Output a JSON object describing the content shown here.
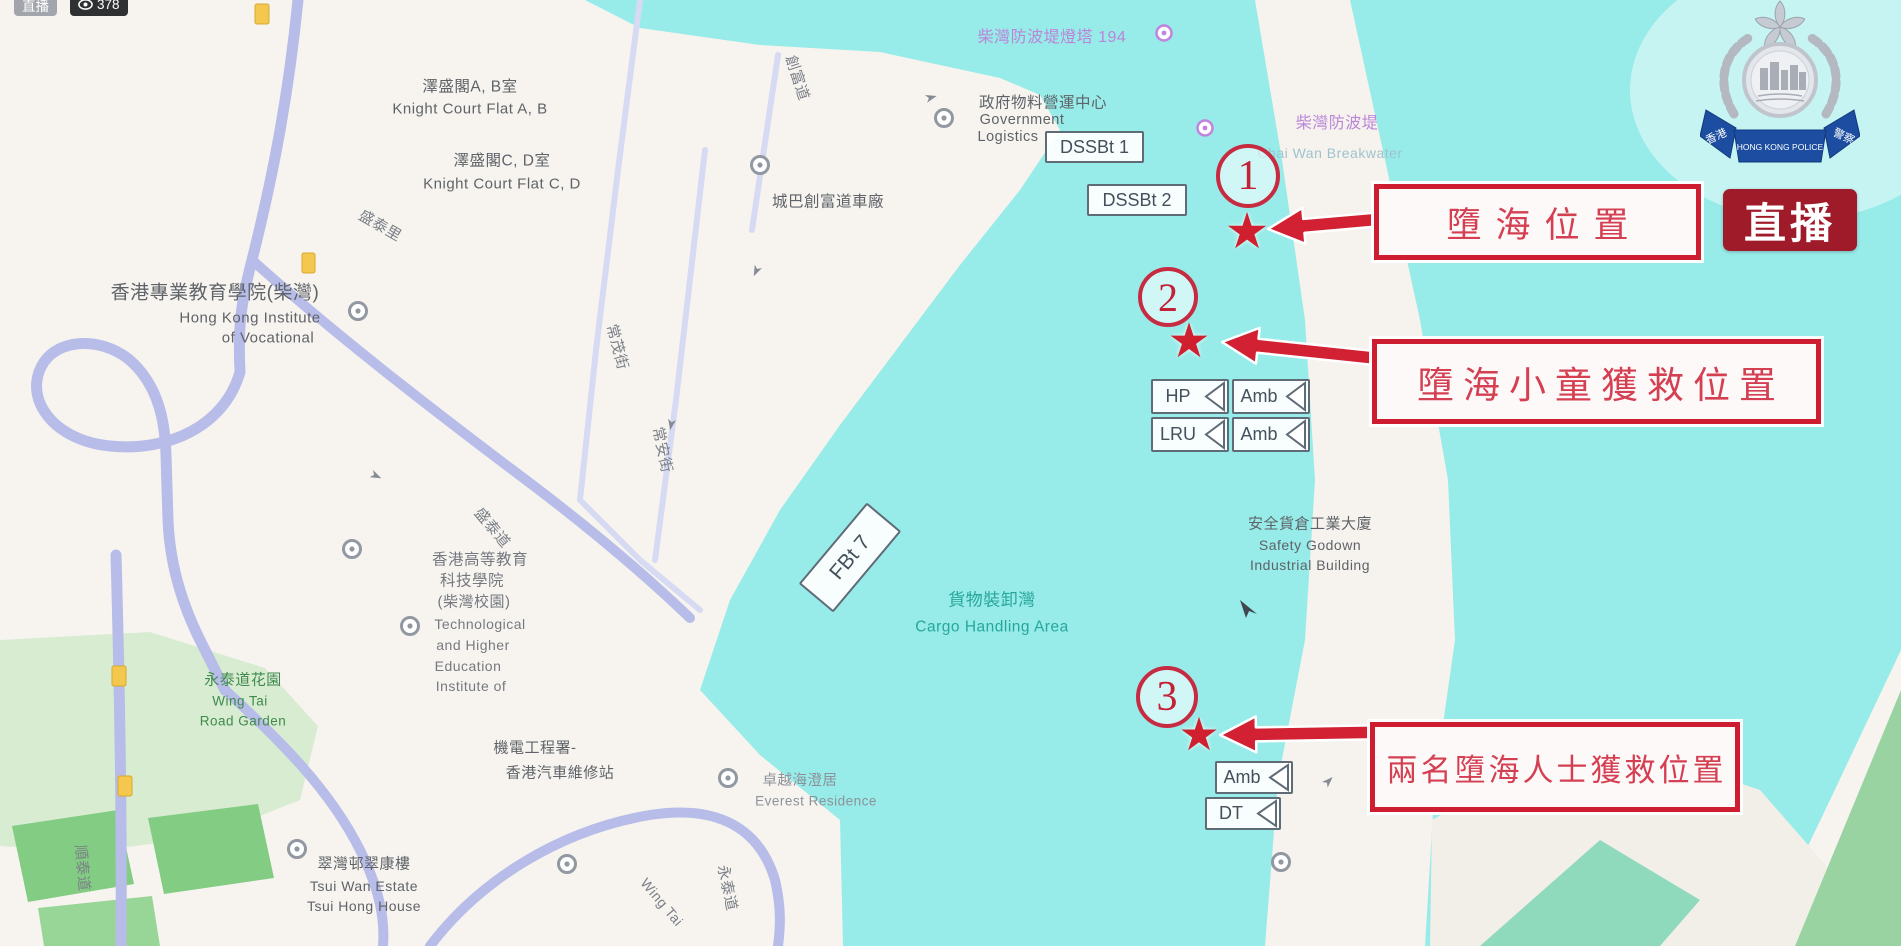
{
  "stream": {
    "live_chip": "直播",
    "viewers": "378"
  },
  "live_overlay": {
    "label": "直播"
  },
  "police_emblem": {
    "left_ribbon": "香港",
    "banner": "HONG KONG POLICE",
    "right_ribbon": "警察"
  },
  "markers": {
    "m1": "1",
    "m2": "2",
    "m3": "3"
  },
  "callouts": {
    "c1": "墮海位置",
    "c2": "墮海小童獲救位置",
    "c3": "兩名墮海人士獲救位置"
  },
  "units": {
    "dssbt1": "DSSBt 1",
    "dssbt2": "DSSBt 2",
    "hp": "HP",
    "amb_top": "Amb",
    "lru": "LRU",
    "amb_bottom": "Amb",
    "amb3": "Amb",
    "dt": "DT",
    "fbt7": "FBt 7"
  },
  "map": {
    "pois": {
      "knight_ab": {
        "zh": "澤盛閣A, B室",
        "en": "Knight Court Flat A, B"
      },
      "knight_cd": {
        "zh": "澤盛閣C, D室",
        "en": "Knight Court Flat C, D"
      },
      "hkive": {
        "zh": "香港專業教育學院(柴灣)",
        "en1": "Hong Kong Institute",
        "en2": "of Vocational"
      },
      "gov": {
        "zh": "政府物料營運中心",
        "en1": "Government",
        "en2": "Logistics"
      },
      "citybus": {
        "zh": "城巴創富道車廠"
      },
      "lighthouse": {
        "zh": "柴灣防波堤燈塔 194"
      },
      "breakwater": {
        "zh": "柴灣防波堤",
        "en": "Chai Wan Breakwater"
      },
      "cargo": {
        "zh": "貨物裝卸灣",
        "en": "Cargo Handling Area"
      },
      "godown": {
        "zh": "安全貨倉工業大廈",
        "en1": "Safety Godown",
        "en2": "Industrial Building"
      },
      "thei": {
        "zh1": "香港高等教育",
        "zh2": "科技學院",
        "zh3": "(柴灣校園)",
        "en1": "Technological",
        "en2": "and Higher",
        "en3": "Education",
        "en4": "Institute of"
      },
      "emsd": {
        "zh1": "機電工程署-",
        "zh2": "香港汽車維修站"
      },
      "everest": {
        "zh": "卓越海澄居",
        "en": "Everest Residence"
      },
      "garden": {
        "zh": "永泰道花園",
        "en1": "Wing Tai",
        "en2": "Road Garden"
      },
      "tsuiwan": {
        "zh": "翠灣邨翠康樓",
        "en1": "Tsui Wan Estate",
        "en2": "Tsui Hong House"
      }
    },
    "streets": {
      "chong_fu": "創富道",
      "sheung_mau": "常茂街",
      "sheung_on": "常安街",
      "shing_tai_lane": "盛泰里",
      "shing_tai": "盛泰道",
      "shun_tai": "順泰道",
      "wing_tai_zh": "永泰道",
      "wing_tai_en": "Wing Tai"
    }
  },
  "colors": {
    "water": "#97ebe8",
    "land": "#f7f4f0",
    "road": "#b7bde8",
    "annotation_red": "#ce1c31",
    "callout_text": "#d43f52",
    "live_badge_red": "#a01b29",
    "ribbon_blue": "#1c4da0",
    "poi_purple": "#bb86d8",
    "cargo_teal": "#27a79b",
    "garden_green": "#3f8a4c"
  }
}
